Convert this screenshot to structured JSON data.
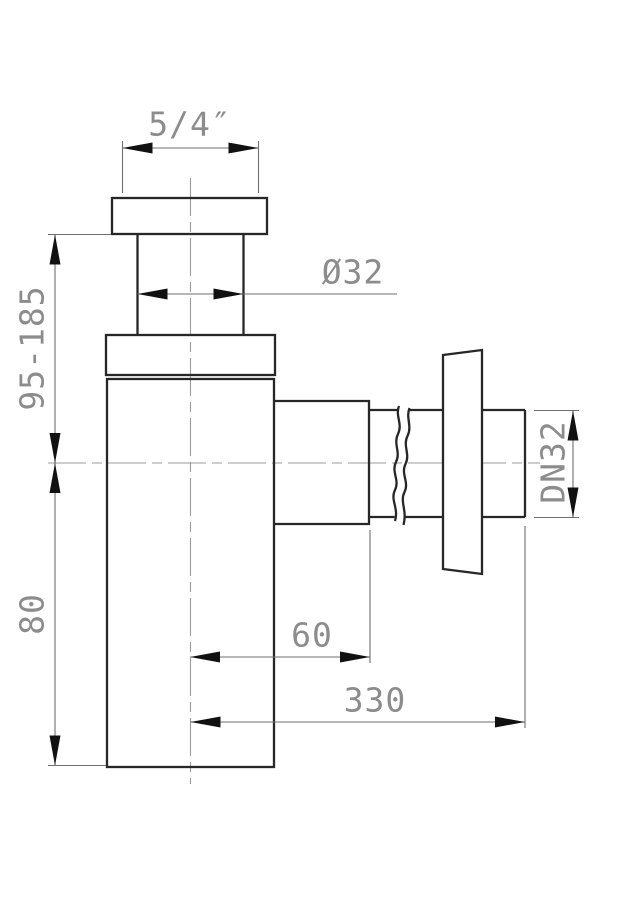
{
  "drawing": {
    "colors": {
      "background": "#ffffff",
      "part_outline": "#272727",
      "dimension_lines": "#6f6f6f",
      "dimension_text": "#8c8c8c",
      "arrowheads": "#111111"
    },
    "dimensions": {
      "inlet_thread": {
        "label": "5/4″"
      },
      "inlet_diameter": {
        "label": "Ø32"
      },
      "adjustable_height": {
        "label": "95-185"
      },
      "body_height": {
        "label": "80"
      },
      "outlet_offset": {
        "label": "60"
      },
      "outlet_length": {
        "label": "330"
      },
      "outlet_nominal_diameter": {
        "label": "DN32"
      }
    }
  }
}
